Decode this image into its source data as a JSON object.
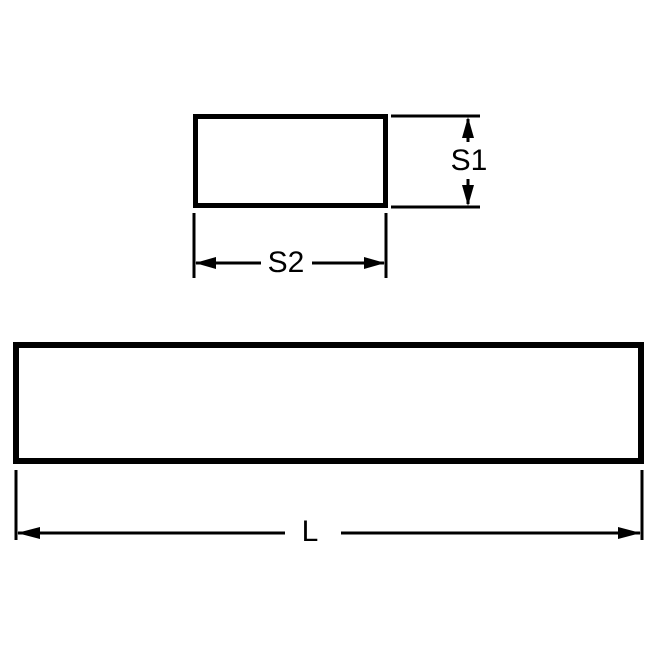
{
  "labels": {
    "s1": "S1",
    "s2": "S2",
    "length": "L"
  },
  "colors": {
    "line": "#000000",
    "background": "#ffffff"
  }
}
